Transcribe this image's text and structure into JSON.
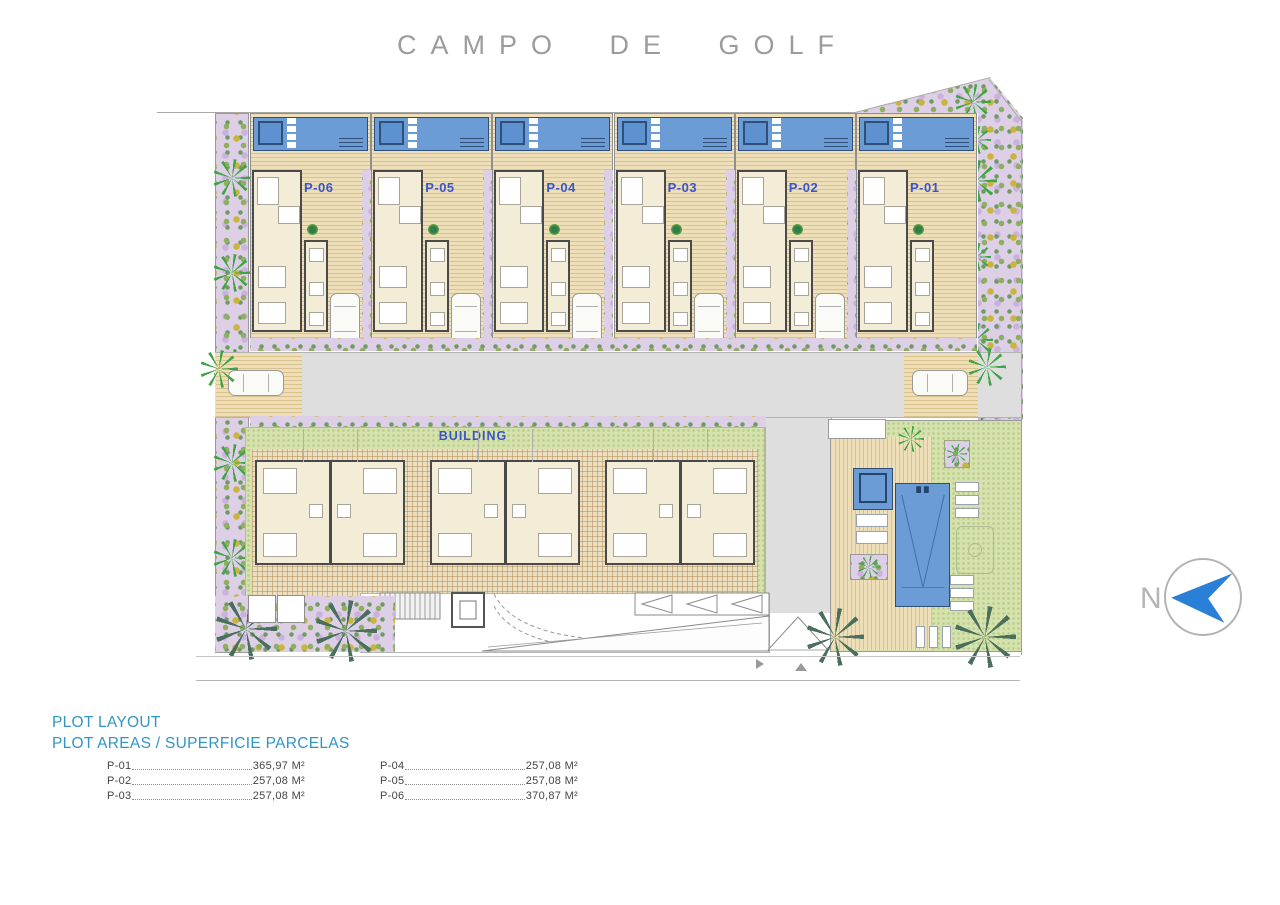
{
  "title": "CAMPO DE GOLF",
  "plan": {
    "building_label": "BUILDING",
    "north_label": "N",
    "plots": [
      {
        "id": "P-06",
        "car": true
      },
      {
        "id": "P-05",
        "car": true
      },
      {
        "id": "P-04",
        "car": true
      },
      {
        "id": "P-03",
        "car": true
      },
      {
        "id": "P-02",
        "car": true
      },
      {
        "id": "P-01",
        "car": false
      }
    ]
  },
  "legend": {
    "heading1": "PLOT LAYOUT",
    "heading2": "PLOT AREAS / SUPERFICIE PARCELAS",
    "rows": [
      {
        "plot": "P-01",
        "area": "365,97 M²"
      },
      {
        "plot": "P-02",
        "area": "257,08 M²"
      },
      {
        "plot": "P-03",
        "area": "257,08 M²"
      },
      {
        "plot": "P-04",
        "area": "257,08 M²"
      },
      {
        "plot": "P-05",
        "area": "257,08 M²"
      },
      {
        "plot": "P-06",
        "area": "370,87 M²"
      }
    ]
  },
  "colors": {
    "pool": "#6b9cd6",
    "pool-dark": "#2f4f79",
    "spa": "#5e91cf",
    "label-blue": "#3a55c8",
    "heading-blue": "#3095c5",
    "lawn": "#d5e2ad",
    "deck-a": "#eedfb8",
    "deck-b": "#d9c28e",
    "garden": "#dccfe6",
    "road": "#dedede",
    "cream": "#f3ecd6",
    "wall": "#4a4a4a",
    "palm-bright": "#3fa544",
    "palm-dark": "#4a6f5d",
    "north-blue": "#2a80d6"
  }
}
